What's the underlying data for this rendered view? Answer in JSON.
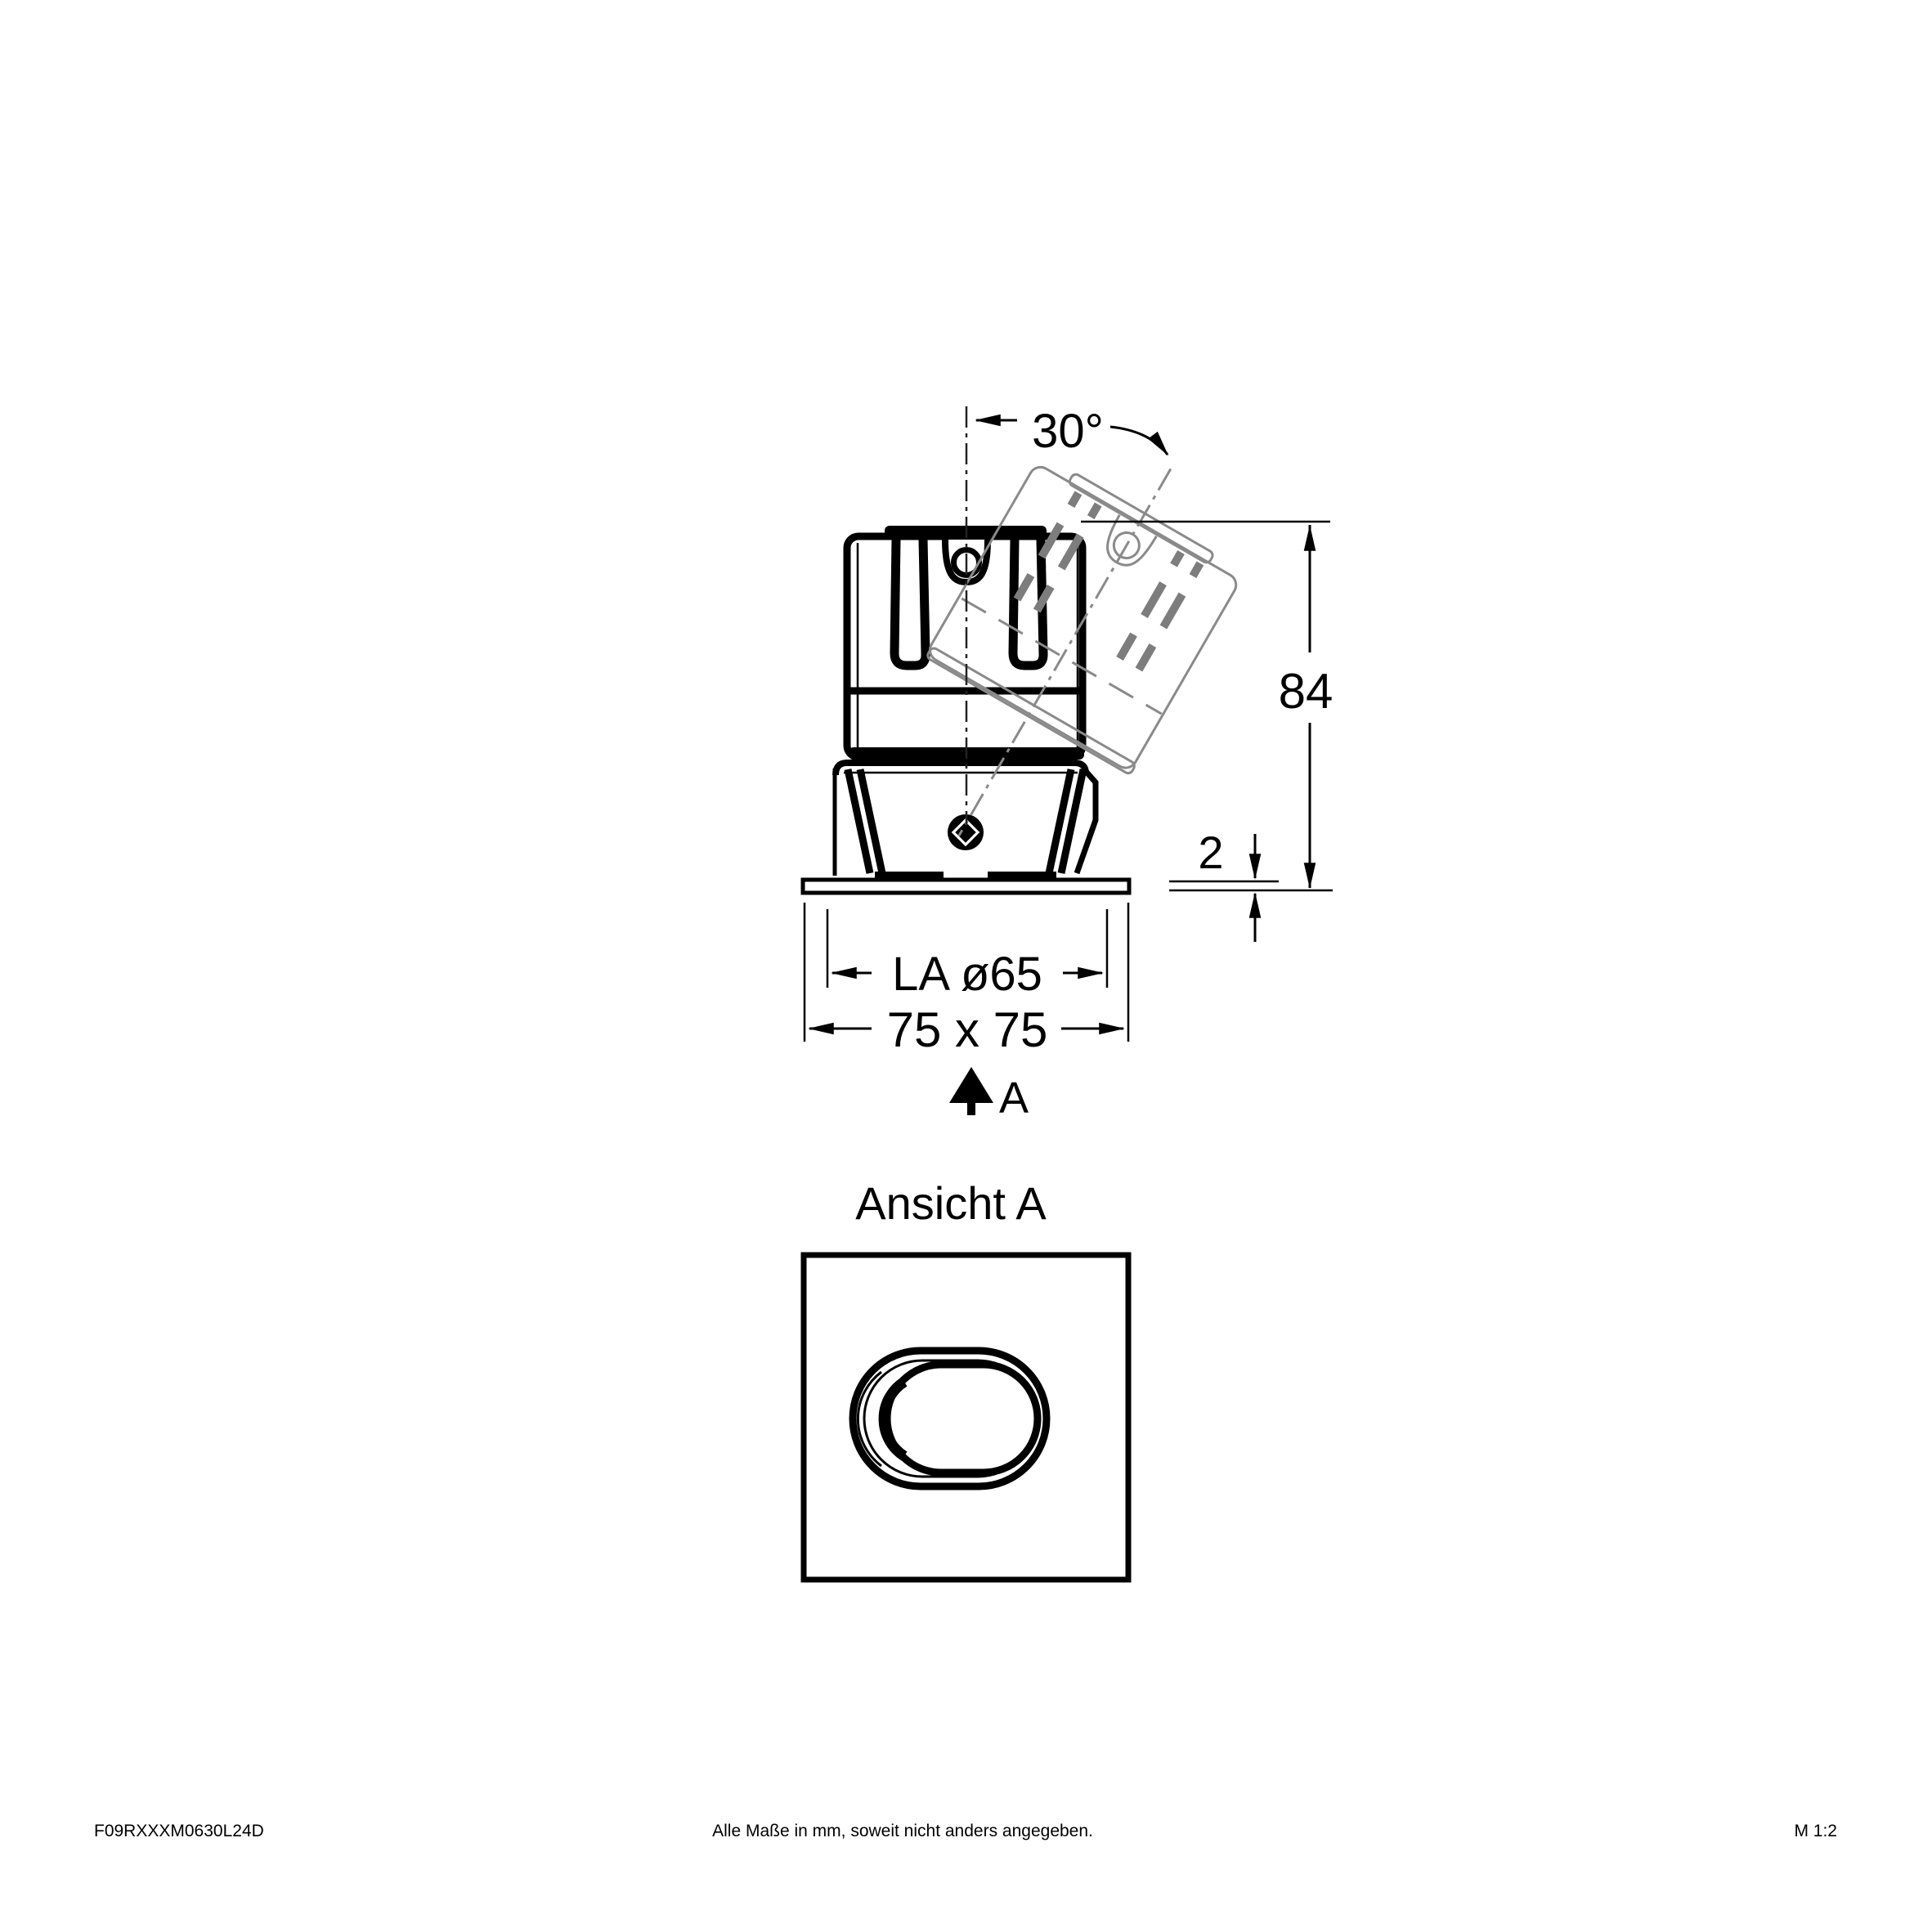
{
  "drawing": {
    "side_view": {
      "tilt_angle_label": "30°",
      "height_label": "84",
      "flange_thickness_label": "2",
      "cutout_label": "LA ø65",
      "flange_size_label": "75 x 75",
      "view_direction_label": "A"
    },
    "front_view": {
      "title": "Ansicht A"
    },
    "colors": {
      "line": "#000000",
      "ghost": "#8a8a8a",
      "background": "#ffffff"
    }
  },
  "footer": {
    "article_number": "F09RXXXM0630L24D",
    "note": "Alle Maße in mm, soweit nicht anders angegeben.",
    "scale": "M 1:2"
  }
}
